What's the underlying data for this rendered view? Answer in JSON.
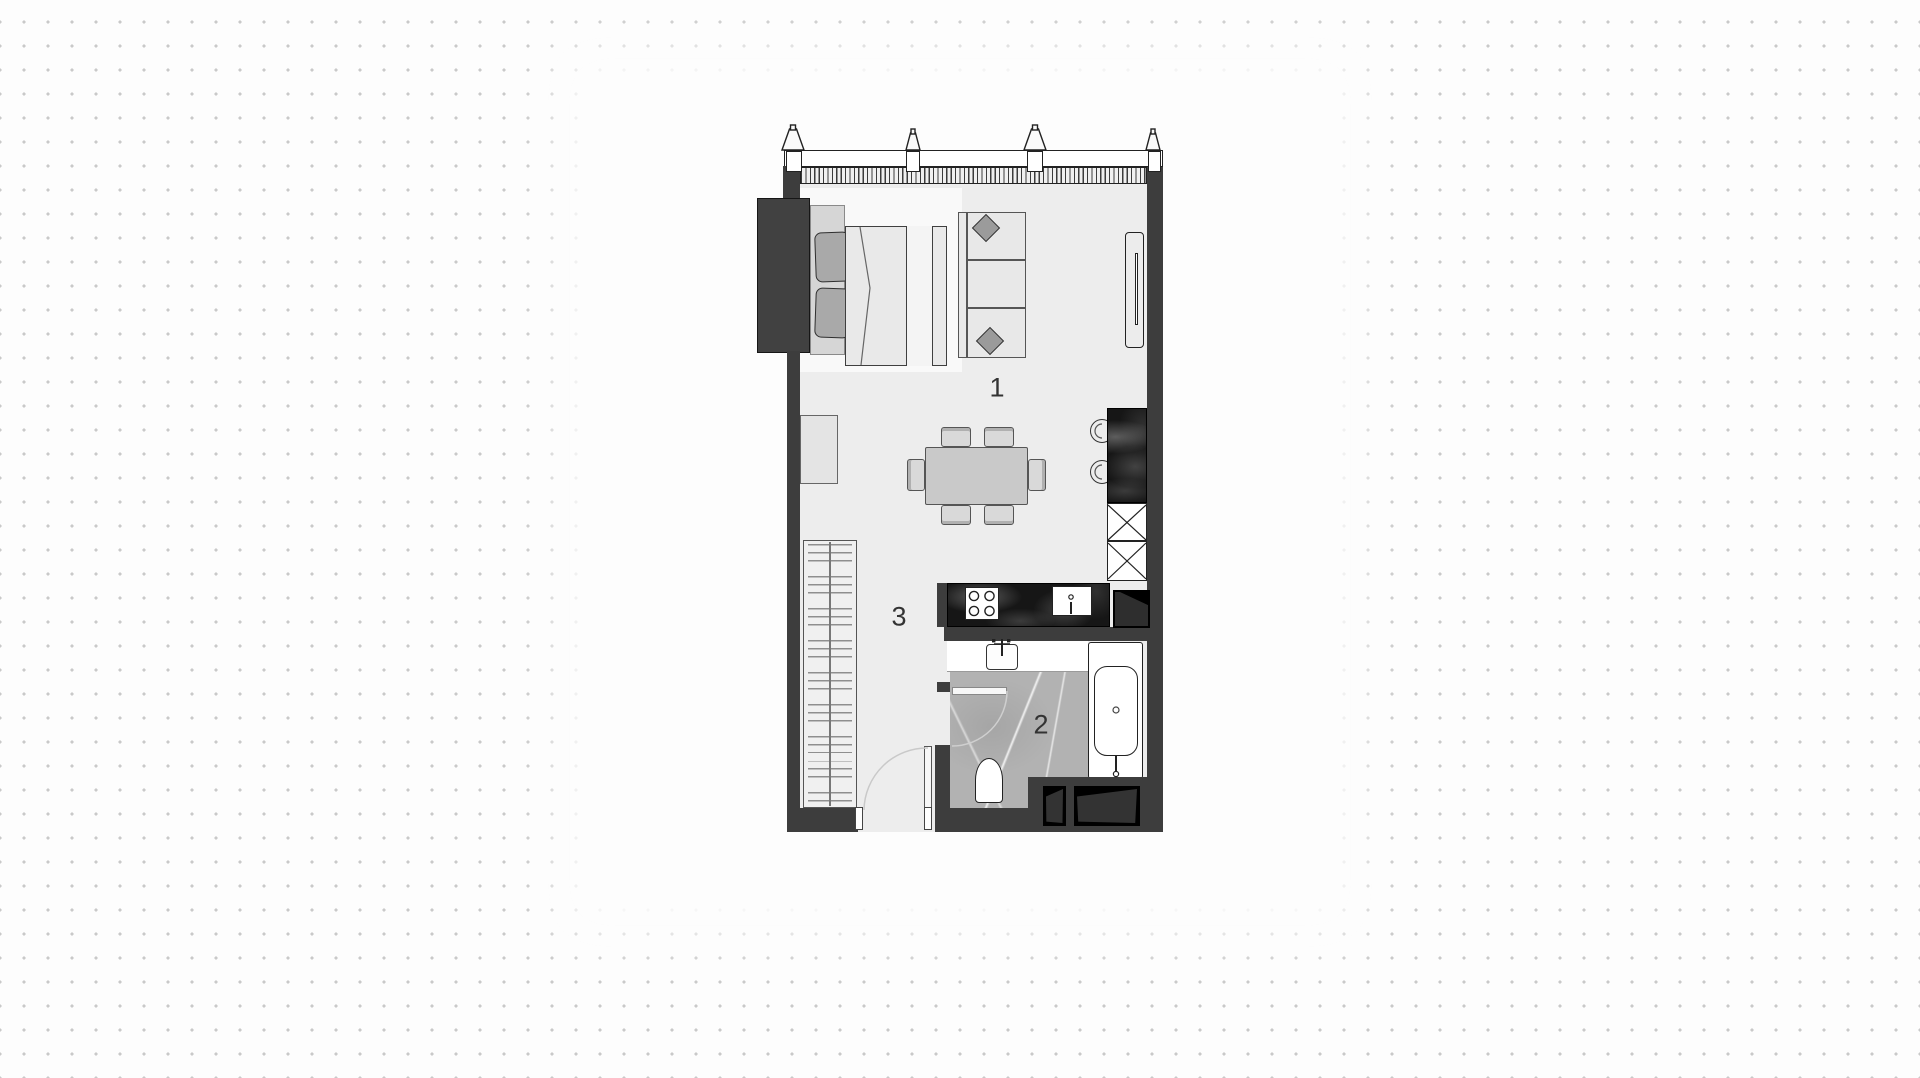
{
  "page": {
    "background_color": "#fdfdfd",
    "dot_color": "#c9c9c9"
  },
  "floorplan": {
    "room_labels": [
      {
        "room": "living-dining",
        "text": "1"
      },
      {
        "room": "bathroom",
        "text": "2"
      },
      {
        "room": "hallway-wardrobe",
        "text": "3"
      }
    ],
    "colors": {
      "wall": "#3d3d3d",
      "floor": "#ededed",
      "rug": "#f9f9f9",
      "kitchen_counter": "#161616",
      "bathroom_floor": "#b2b2b2",
      "background": "#fdfdfd",
      "dot": "#c9c9c9"
    },
    "elements": [
      "balcony-window",
      "bed",
      "pillows",
      "sofa",
      "throw-pillows",
      "tv",
      "dining-table",
      "chairs",
      "bar-counter",
      "bar-stools",
      "tall-units",
      "stove",
      "kitchen-sink",
      "vanity-basin",
      "bathtub",
      "toilet",
      "wardrobe",
      "entry-door",
      "bathroom-door",
      "shafts"
    ]
  }
}
